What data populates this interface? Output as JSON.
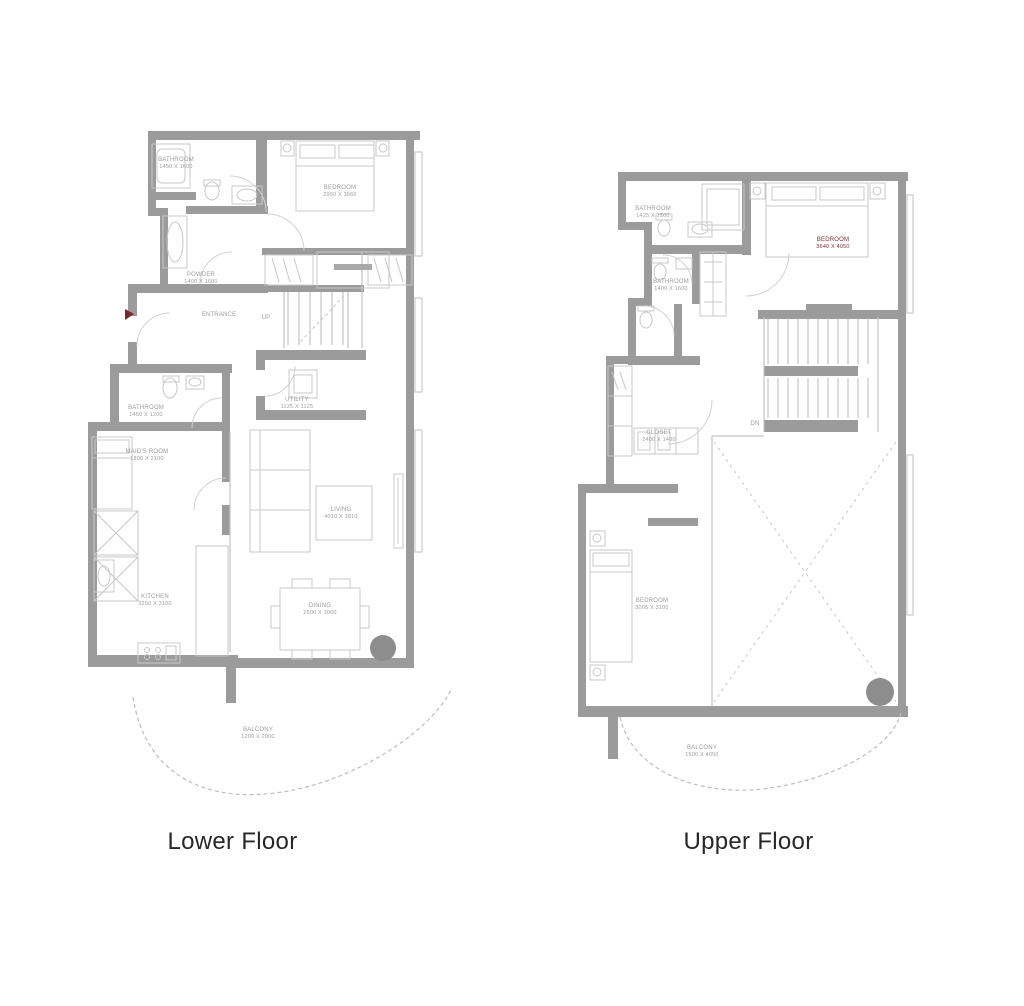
{
  "figure": {
    "lower": {
      "caption": "Lower Floor",
      "stairs_label": "UP",
      "rooms": {
        "bathroom1": {
          "name": "BATHROOM",
          "dims": "1450 X 1600"
        },
        "bedroom": {
          "name": "BEDROOM",
          "dims": "2950 X 3660"
        },
        "powder": {
          "name": "POWDER",
          "dims": "1400 X 1600"
        },
        "entrance": {
          "name": "ENTRANCE"
        },
        "bathroom2": {
          "name": "BATHROOM",
          "dims": "1450 X 1200"
        },
        "maids_room": {
          "name": "MAID'S ROOM",
          "dims": "1800 X 2100"
        },
        "utility": {
          "name": "UTILITY",
          "dims": "1125 X 1125"
        },
        "living": {
          "name": "LIVING",
          "dims": "4010 X 3810"
        },
        "kitchen": {
          "name": "KITCHEN",
          "dims": "3250 X 3100"
        },
        "dining": {
          "name": "DINING",
          "dims": "2500 X 3060"
        },
        "balcony": {
          "name": "BALCONY",
          "dims": "1200 X 2000"
        }
      }
    },
    "upper": {
      "caption": "Upper Floor",
      "stairs_label": "DN",
      "rooms": {
        "bathroom1": {
          "name": "BATHROOM",
          "dims": "1425 X 1500"
        },
        "bathroom2": {
          "name": "BATHROOM",
          "dims": "1400 X 1600"
        },
        "bedroom2": {
          "name": "BEDROOM",
          "dims": "3640 X 4050"
        },
        "closet": {
          "name": "CLOSET",
          "dims": "2400 X 1400"
        },
        "bedroom3": {
          "name": "BEDROOM",
          "dims": "3005 X 3100"
        },
        "balcony": {
          "name": "BALCONY",
          "dims": "1500 X 4050"
        }
      }
    }
  },
  "colors": {
    "background": "#ffffff",
    "wall": "#9b9b9b",
    "thin_line": "#c3c3c3",
    "label_text": "#9c9c9c",
    "accent_label_text": "#7c2f2f",
    "caption_text": "#282828",
    "column": "#8d8d8d",
    "entrance_marker": "#7c2727"
  }
}
